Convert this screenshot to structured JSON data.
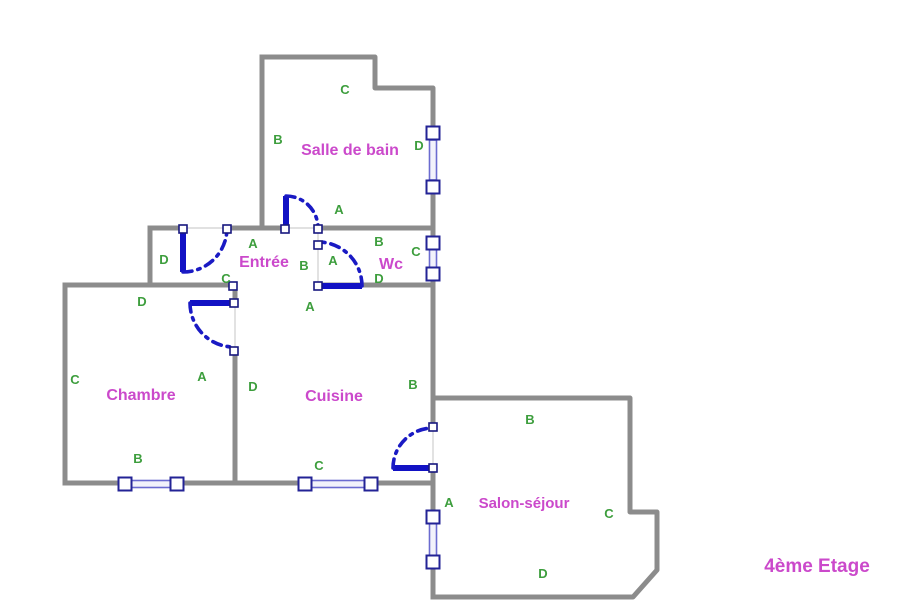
{
  "floor_label": {
    "text": "4ème Etage",
    "x": 817,
    "y": 572
  },
  "colors": {
    "wall_gray": "#8c8c8c",
    "room_name_magenta": "#cb49cb",
    "wall_letter_green": "#3d9e3d",
    "door_blue": "#1212c4",
    "window_blue": "#6b6bd0",
    "jamb_border_navy": "#232396",
    "background": "#ffffff"
  },
  "rooms": [
    {
      "id": "salle-de-bain",
      "name": "Salle de bain",
      "x": 350,
      "y": 155,
      "small": false,
      "wall_labels": [
        {
          "text": "A",
          "x": 339,
          "y": 214
        },
        {
          "text": "B",
          "x": 278,
          "y": 144
        },
        {
          "text": "C",
          "x": 345,
          "y": 94
        },
        {
          "text": "D",
          "x": 419,
          "y": 150
        }
      ]
    },
    {
      "id": "entree",
      "name": "Entrée",
      "x": 264,
      "y": 267,
      "small": false,
      "wall_labels": [
        {
          "text": "A",
          "x": 253,
          "y": 248
        },
        {
          "text": "B",
          "x": 304,
          "y": 270
        },
        {
          "text": "C",
          "x": 226,
          "y": 283
        },
        {
          "text": "D",
          "x": 164,
          "y": 264
        }
      ]
    },
    {
      "id": "wc",
      "name": "Wc",
      "x": 391,
      "y": 269,
      "small": false,
      "wall_labels": [
        {
          "text": "A",
          "x": 333,
          "y": 265
        },
        {
          "text": "B",
          "x": 379,
          "y": 246
        },
        {
          "text": "C",
          "x": 416,
          "y": 256
        },
        {
          "text": "D",
          "x": 379,
          "y": 283
        }
      ]
    },
    {
      "id": "chambre",
      "name": "Chambre",
      "x": 141,
      "y": 400,
      "small": false,
      "wall_labels": [
        {
          "text": "A",
          "x": 202,
          "y": 381
        },
        {
          "text": "B",
          "x": 138,
          "y": 463
        },
        {
          "text": "C",
          "x": 75,
          "y": 384
        },
        {
          "text": "D",
          "x": 142,
          "y": 306
        }
      ]
    },
    {
      "id": "cuisine",
      "name": "Cuisine",
      "x": 334,
      "y": 401,
      "small": false,
      "wall_labels": [
        {
          "text": "A",
          "x": 310,
          "y": 311
        },
        {
          "text": "B",
          "x": 413,
          "y": 389
        },
        {
          "text": "C",
          "x": 319,
          "y": 470
        },
        {
          "text": "D",
          "x": 253,
          "y": 391
        }
      ]
    },
    {
      "id": "salon-sejour",
      "name": "Salon-séjour",
      "x": 524,
      "y": 508,
      "small": true,
      "wall_labels": [
        {
          "text": "A",
          "x": 449,
          "y": 507
        },
        {
          "text": "B",
          "x": 530,
          "y": 424
        },
        {
          "text": "C",
          "x": 609,
          "y": 518
        },
        {
          "text": "D",
          "x": 543,
          "y": 578
        }
      ]
    }
  ]
}
